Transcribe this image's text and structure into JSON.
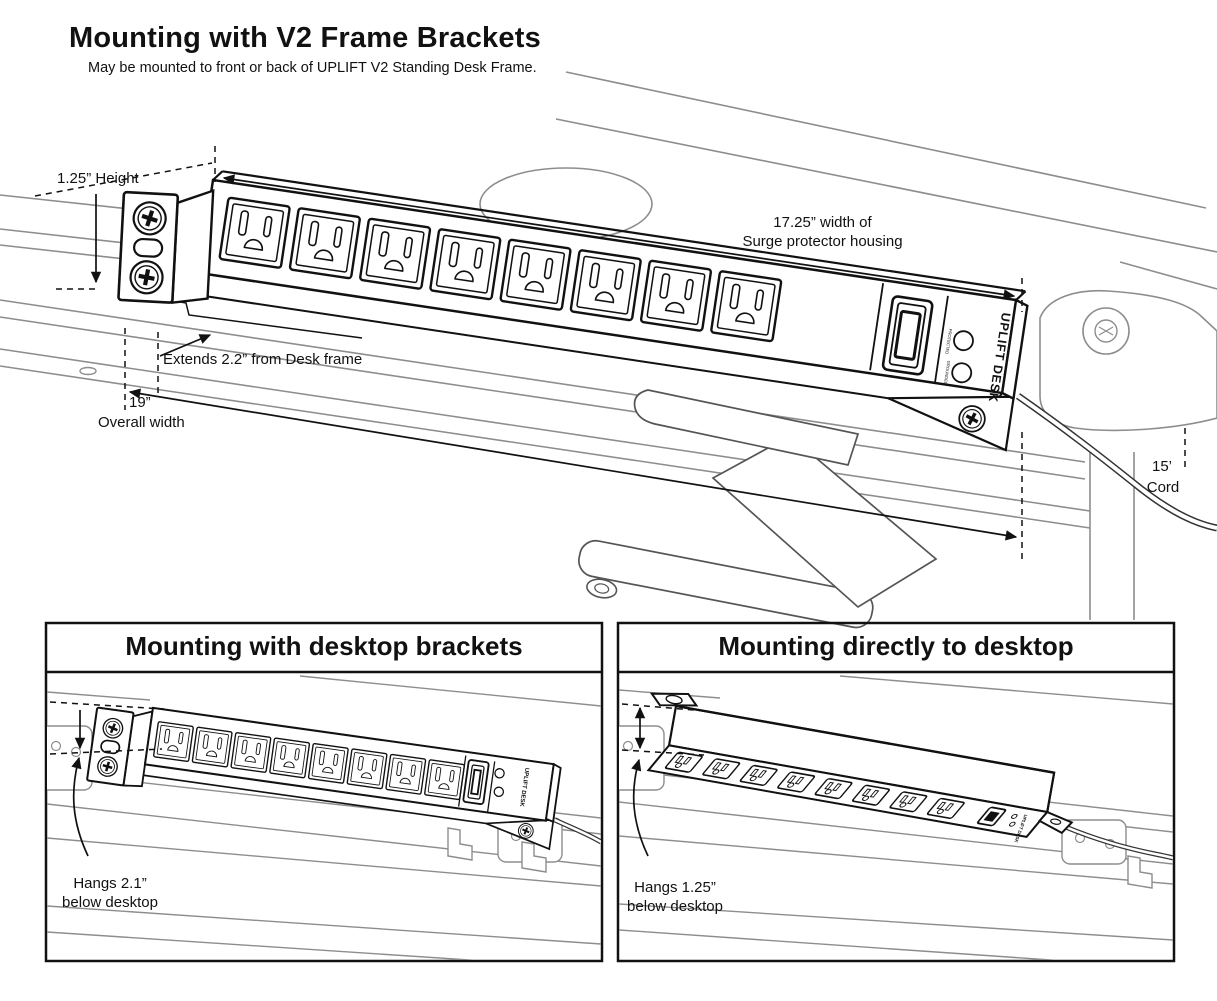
{
  "header": {
    "title": "Mounting with V2 Frame Brackets",
    "subtitle": "May be mounted to front or back of UPLIFT V2 Standing Desk Frame."
  },
  "main_diagram": {
    "labels": {
      "height": "1.25” Height",
      "extends": "Extends 2.2” from Desk frame",
      "overall_width_value": "19”",
      "overall_width_caption": "Overall width",
      "housing_width_line1": "17.25” width of",
      "housing_width_line2": "Surge protector housing",
      "cord_value": "15’",
      "cord_caption": "Cord"
    },
    "device": {
      "brand": "UPLIFT DESK",
      "indicator_labels": [
        "PROTECTED",
        "GROUNDED"
      ],
      "outlet_count": 8
    }
  },
  "panels": [
    {
      "title": "Mounting with desktop brackets",
      "hang_line1": "Hangs 2.1”",
      "hang_line2": "below desktop"
    },
    {
      "title": "Mounting directly to desktop",
      "hang_line1": "Hangs 1.25”",
      "hang_line2": "below desktop"
    }
  ],
  "colors": {
    "line": "#111111",
    "frame_line": "#8d8d8d",
    "background": "#ffffff"
  }
}
